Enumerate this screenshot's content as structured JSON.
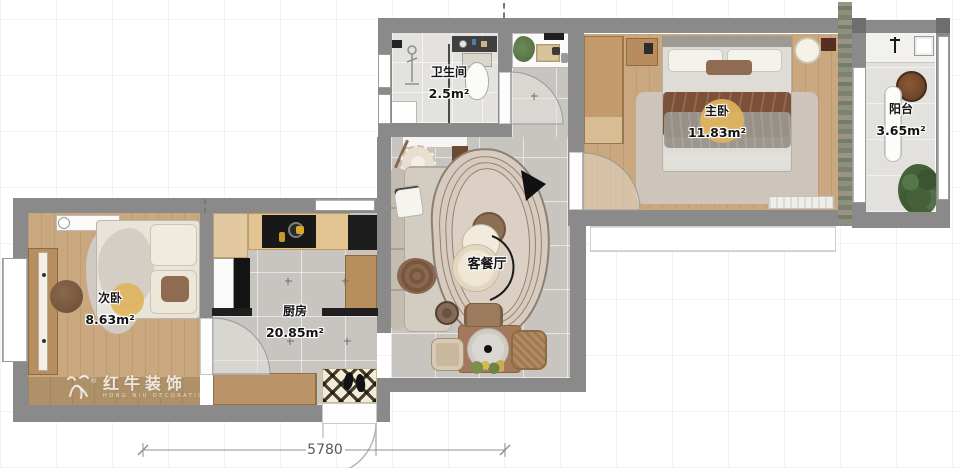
{
  "rooms": {
    "bathroom": {
      "name": "卫生间",
      "area": "2.5m²"
    },
    "master": {
      "name": "主卧",
      "area": "11.83m²"
    },
    "balcony": {
      "name": "阳台",
      "area": "3.65m²"
    },
    "second": {
      "name": "次卧",
      "area": "8.63m²"
    },
    "kitchen": {
      "name": "厨房",
      "area": "20.85m²"
    },
    "living": {
      "name": "客餐厅",
      "area": ""
    }
  },
  "dimension": {
    "value": "5780"
  },
  "watermark": {
    "brand": "红牛装饰",
    "sub": "HONG NIU DECORATION",
    "reg": "®"
  },
  "colors": {
    "wall": "#8a8a8a",
    "accent_circle": "#dfb45c",
    "tile": "#c8c5c1",
    "wood_floor": "#c9a77f",
    "label_text": "#141414"
  }
}
